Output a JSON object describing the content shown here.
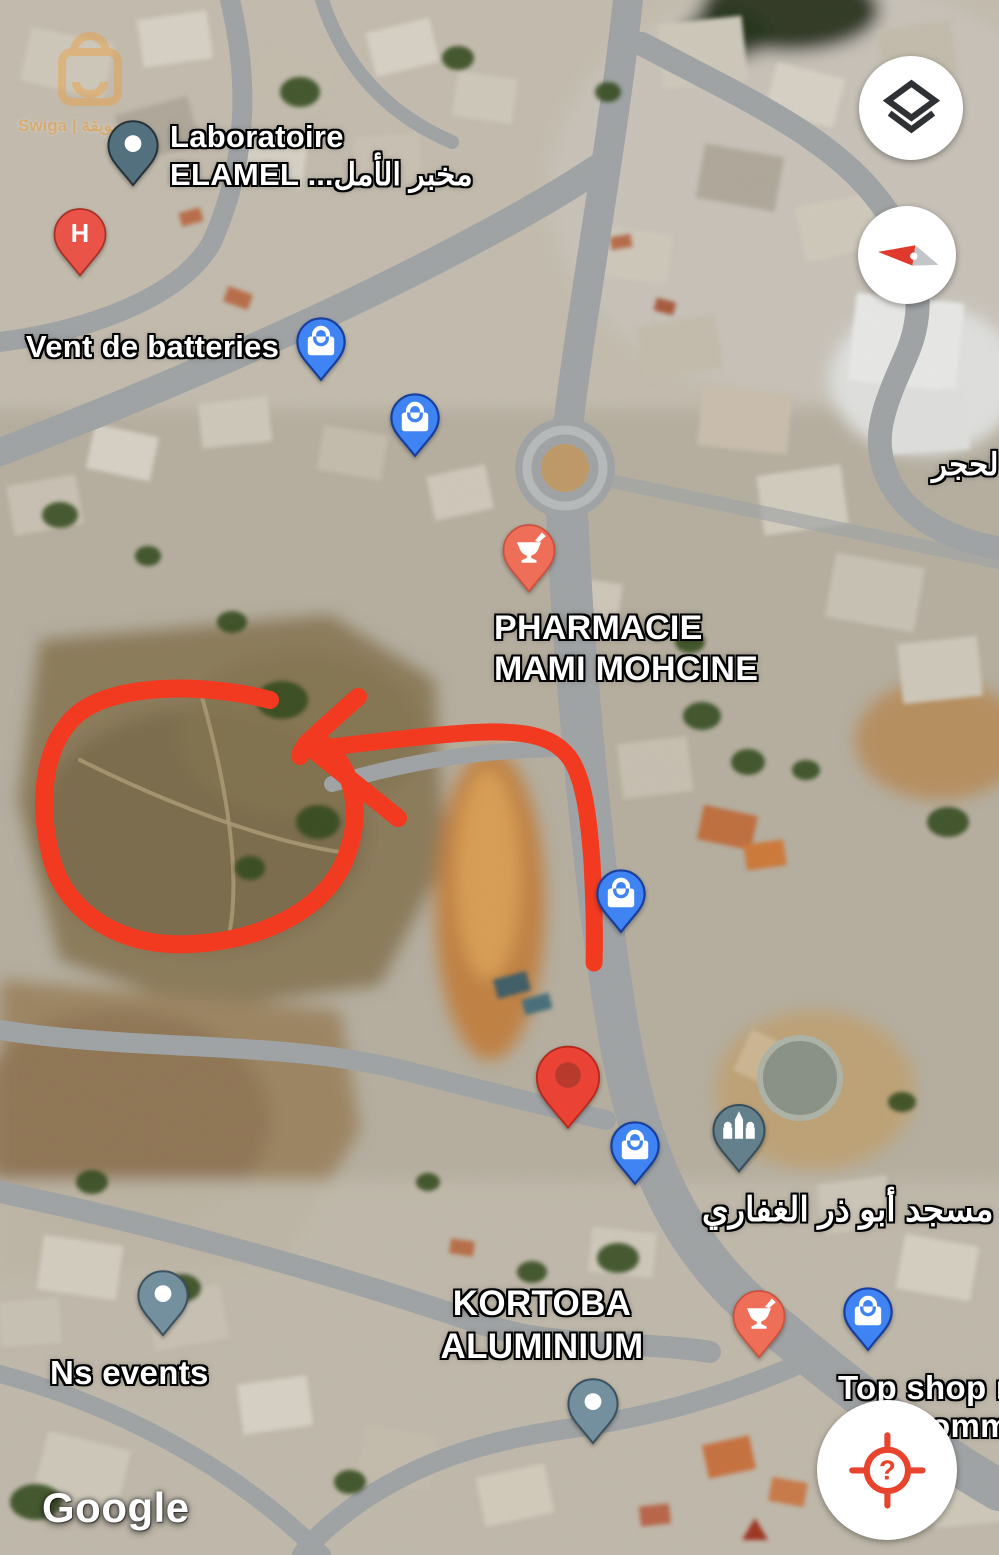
{
  "branding": {
    "google_logo": "Google",
    "watermark_text": "Swiga | سويقة"
  },
  "labels": {
    "laboratoire": {
      "line1": "Laboratoire",
      "line2_latin": "ELAMEL",
      "line2_arabic": "مخبر الأمل..."
    },
    "vent_de_batteries": "Vent de batteries",
    "pharmacie": {
      "line1": "PHARMACIE",
      "line2": "MAMI MOHCINE"
    },
    "hajar_right_edge": "لحجر",
    "mosque_abu_dhar": "مسجد أبو ذر الغفاري",
    "kortoba": {
      "line1": "KORTOBA",
      "line2": "ALUMINIUM"
    },
    "ns_events": "Ns events",
    "top_shop": {
      "line1": "Top shop m",
      "line2": "omm"
    }
  },
  "markers": {
    "laboratory": {
      "icon": "dot-pin",
      "color": "#53707F"
    },
    "hospital": {
      "icon": "hospital-h-pin",
      "letter": "H",
      "color": "#EA5347"
    },
    "shopping": {
      "icon": "shopping-bag-pin",
      "color": "#4083F2",
      "count": 5
    },
    "pharmacy": {
      "icon": "pharmacy-mortar-pin",
      "color": "#EF6E58",
      "count": 2
    },
    "mosque": {
      "icon": "mosque-pin",
      "color": "#64808D"
    },
    "place_generic": {
      "icon": "dot-pin",
      "color": "#74909E",
      "count": 2
    },
    "dropped_pin": {
      "icon": "red-map-pin",
      "color": "#EA4335",
      "inner_color": "#B73A2C"
    }
  },
  "controls": {
    "layers": {
      "icon": "layers-icon",
      "color": "#2E3235"
    },
    "compass": {
      "icon": "compass-needle-icon",
      "needle_red": "#DF3A2B",
      "needle_gray": "#C3C6C8"
    },
    "my_location": {
      "icon": "my-location-crosshair-icon",
      "glyph": "?",
      "color": "#E8432C"
    }
  },
  "annotation": {
    "color": "#F23A20",
    "parts": [
      "land-circle",
      "arrow",
      "route-line"
    ]
  }
}
